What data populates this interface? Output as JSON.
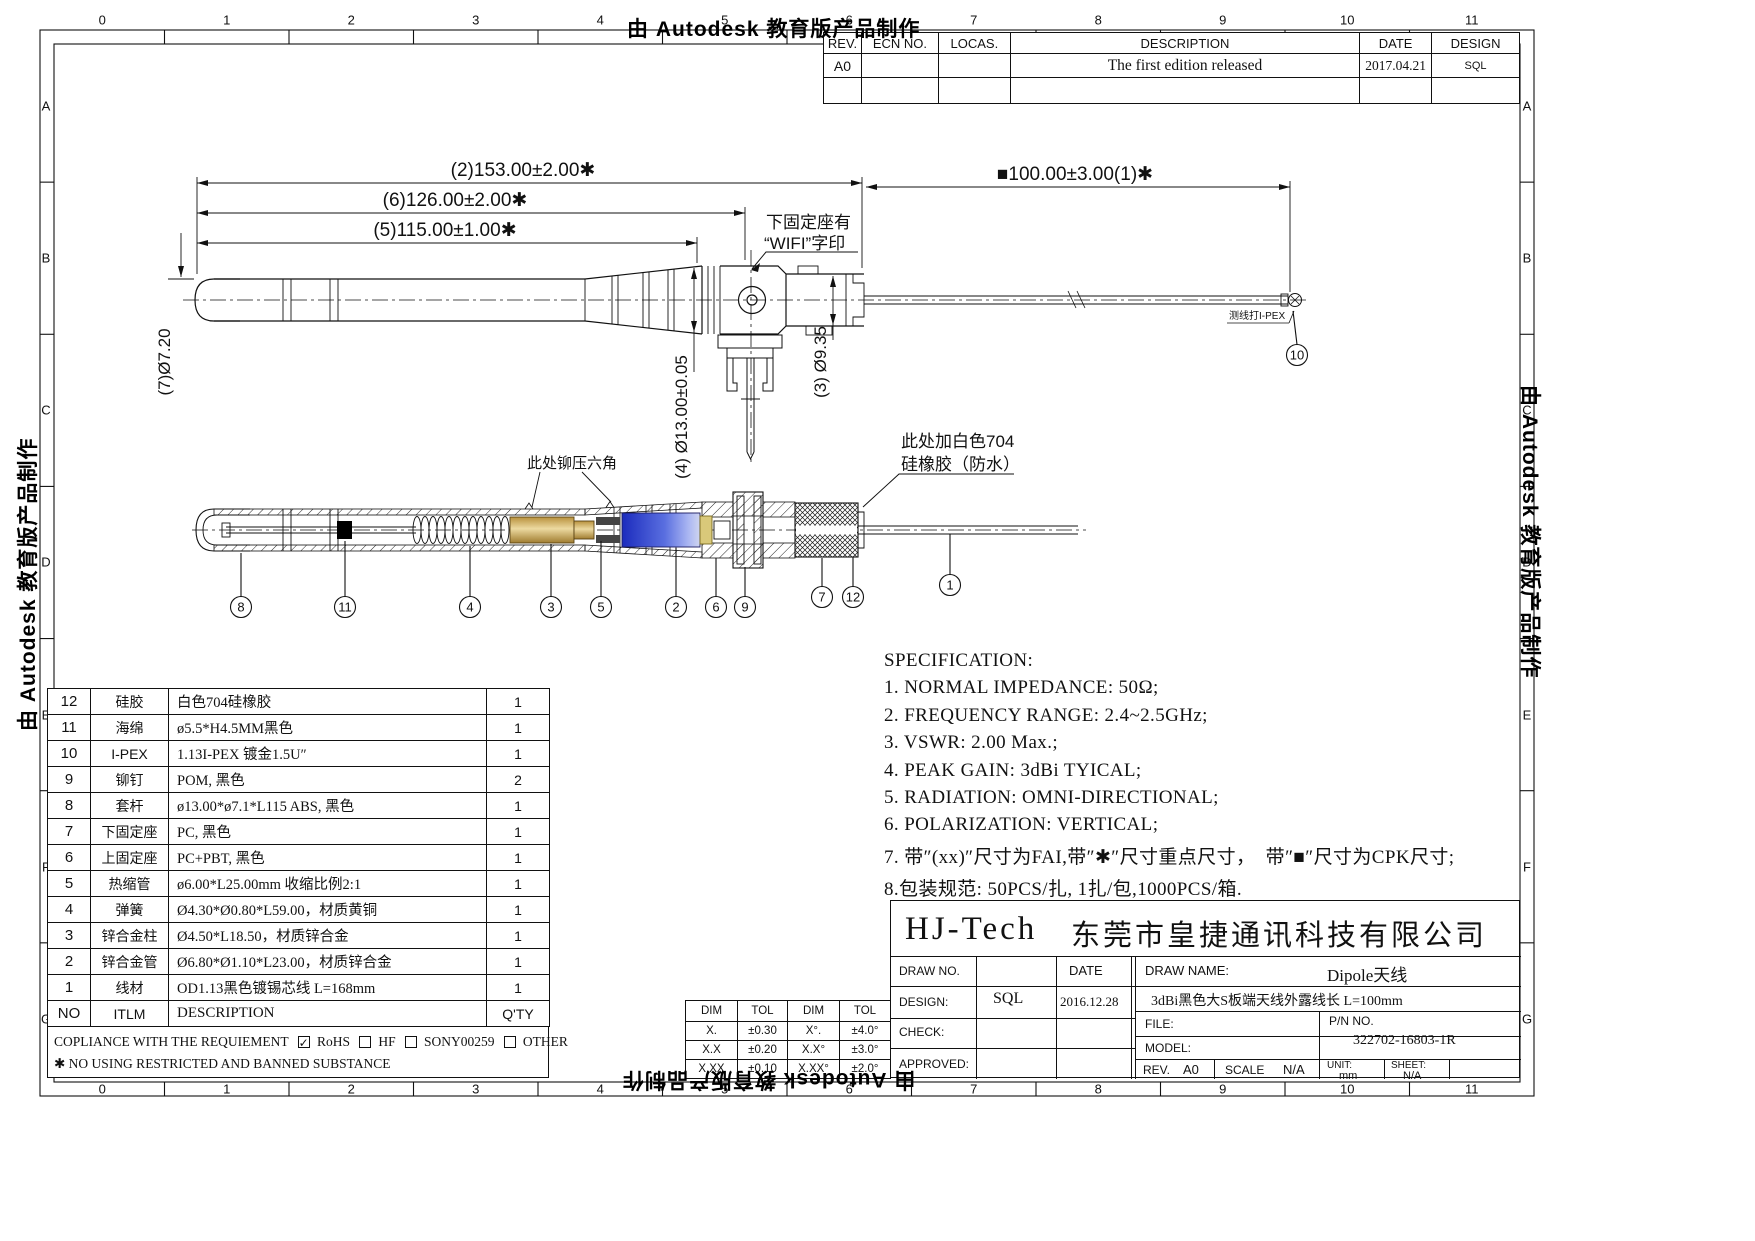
{
  "watermark": {
    "text": "由 Autodesk 教育版产品制作"
  },
  "frame": {
    "column_labels": [
      "0",
      "1",
      "2",
      "3",
      "4",
      "5",
      "6",
      "7",
      "8",
      "9",
      "10",
      "11"
    ],
    "row_labels": [
      "A",
      "B",
      "C",
      "D",
      "E",
      "F",
      "G"
    ]
  },
  "revision_table": {
    "headers": [
      "REV.",
      "ECN NO.",
      "LOCAS.",
      "DESCRIPTION",
      "DATE",
      "DESIGN"
    ],
    "rows": [
      {
        "rev": "A0",
        "ecn_no": "",
        "locas": "",
        "description": "The first edition released",
        "date": "2017.04.21",
        "design": "SQL"
      }
    ]
  },
  "drawing": {
    "dim_153": "(2)153.00±2.00✱",
    "dim_126": "(6)126.00±2.00✱",
    "dim_115": "(5)115.00±1.00✱",
    "dim_100": "■100.00±3.00(1)✱",
    "dim_7_20": "(7)Ø7.20",
    "dim_13": "(4) Ø13.00±0.05",
    "dim_9_35": "(3) Ø9.35",
    "note_wifi_line1": "下固定座有",
    "note_wifi_line2": "“WIFI”字印",
    "note_silicone_line1": "此处加白色704",
    "note_silicone_line2": "硅橡胶（防水）",
    "note_hex": "此处铆压六角",
    "note_ipex": "测线打I-PEX",
    "upper_balloon": {
      "n": "10",
      "x": 1297,
      "y": 355,
      "tx": 1293,
      "ty": 311
    },
    "section_balloons": [
      {
        "n": "8",
        "x": 241,
        "y": 607,
        "tx": 241,
        "ty": 553
      },
      {
        "n": "11",
        "x": 345,
        "y": 607,
        "tx": 345,
        "ty": 541
      },
      {
        "n": "4",
        "x": 470,
        "y": 607,
        "tx": 470,
        "ty": 546
      },
      {
        "n": "3",
        "x": 551,
        "y": 607,
        "tx": 551,
        "ty": 544
      },
      {
        "n": "5",
        "x": 601,
        "y": 607,
        "tx": 601,
        "ty": 541
      },
      {
        "n": "2",
        "x": 676,
        "y": 607,
        "tx": 676,
        "ty": 548
      },
      {
        "n": "6",
        "x": 716,
        "y": 607,
        "tx": 716,
        "ty": 558
      },
      {
        "n": "9",
        "x": 745,
        "y": 607,
        "tx": 745,
        "ty": 567
      },
      {
        "n": "7",
        "x": 822,
        "y": 597,
        "tx": 822,
        "ty": 558
      },
      {
        "n": "12",
        "x": 853,
        "y": 597,
        "tx": 853,
        "ty": 557
      },
      {
        "n": "1",
        "x": 950,
        "y": 585,
        "tx": 950,
        "ty": 534
      }
    ]
  },
  "specification": {
    "title": "SPECIFICATION:",
    "lines": [
      "1. NORMAL IMPEDANCE: 50Ω;",
      "2. FREQUENCY RANGE: 2.4~2.5GHz;",
      "3. VSWR: 2.00 Max.;",
      "4. PEAK GAIN: 3dBi TYICAL;",
      "5. RADIATION: OMNI-DIRECTIONAL;",
      "6. POLARIZATION: VERTICAL;",
      "7. 带″(xx)″尺寸为FAI,带″✱″尺寸重点尺寸，  带″■″尺寸为CPK尺寸;",
      "8.包装规范: 50PCS/扎, 1扎/包,1000PCS/箱."
    ]
  },
  "bom": {
    "headers": {
      "no": "NO",
      "item": "ITLM",
      "description": "DESCRIPTION",
      "qty": "Q'TY"
    },
    "rows": [
      {
        "no": "12",
        "item": "硅胶",
        "description": "白色704硅橡胶",
        "qty": "1"
      },
      {
        "no": "11",
        "item": "海绵",
        "description": "ø5.5*H4.5MM黑色",
        "qty": "1"
      },
      {
        "no": "10",
        "item": "I-PEX",
        "description": "1.13I-PEX 镀金1.5U″",
        "qty": "1"
      },
      {
        "no": "9",
        "item": "铆钉",
        "description": "POM, 黑色",
        "qty": "2"
      },
      {
        "no": "8",
        "item": "套杆",
        "description": "ø13.00*ø7.1*L115 ABS, 黑色",
        "qty": "1"
      },
      {
        "no": "7",
        "item": "下固定座",
        "description": "PC, 黑色",
        "qty": "1"
      },
      {
        "no": "6",
        "item": "上固定座",
        "description": "PC+PBT, 黑色",
        "qty": "1"
      },
      {
        "no": "5",
        "item": "热缩管",
        "description": "ø6.00*L25.00mm  收缩比例2:1",
        "qty": "1"
      },
      {
        "no": "4",
        "item": "弹簧",
        "description": "Ø4.30*Ø0.80*L59.00，材质黄铜",
        "qty": "1"
      },
      {
        "no": "3",
        "item": "锌合金柱",
        "description": "Ø4.50*L18.50，材质锌合金",
        "qty": "1"
      },
      {
        "no": "2",
        "item": "锌合金管",
        "description": "Ø6.80*Ø1.10*L23.00，材质锌合金",
        "qty": "1"
      },
      {
        "no": "1",
        "item": "线材",
        "description": "OD1.13黑色镀锡芯线 L=168mm",
        "qty": "1"
      }
    ],
    "compliance": {
      "prefix": "COPLIANCE WITH THE REQUIEMENT",
      "options": [
        {
          "label": "RoHS",
          "checked": true
        },
        {
          "label": "HF",
          "checked": false
        },
        {
          "label": "SONY00259",
          "checked": false
        },
        {
          "label": "OTHER",
          "checked": false
        }
      ],
      "note": "✱ NO USING RESTRICTED AND BANNED SUBSTANCE"
    }
  },
  "tolerance_table": {
    "headers": [
      "DIM",
      "TOL",
      "DIM",
      "TOL"
    ],
    "rows": [
      [
        "X.",
        "±0.30",
        "X°.",
        "±4.0°"
      ],
      [
        "X.X",
        "±0.20",
        "X.X°",
        "±3.0°"
      ],
      [
        "X.XX",
        "±0.10",
        "X.XX°",
        "±2.0°"
      ]
    ]
  },
  "title_block": {
    "logo": "HJ-Tech",
    "company": "东莞市皇捷通讯科技有限公司",
    "draw_no_label": "DRAW NO.",
    "date_label": "DATE",
    "design_label": "DESIGN:",
    "design_value": "SQL",
    "design_date": "2016.12.28",
    "check_label": "CHECK:",
    "approved_label": "APPROVED:",
    "draw_name_label": "DRAW NAME:",
    "draw_name_value": "Dipole天线",
    "draw_name_sub": "3dBi黑色大S板端天线外露线长 L=100mm",
    "file_label": "FILE:",
    "pn_label": "P/N NO.",
    "pn_value": "322702-16803-1R",
    "model_label": "MODEL:",
    "rev_label": "REV.",
    "rev_value": "A0",
    "scale_label": "SCALE",
    "scale_value": "N/A",
    "unit_label": "UNIT:",
    "unit_value": "mm",
    "sheet_label": "SHEET:",
    "sheet_value": "N/A"
  },
  "colors": {
    "line": "#111111",
    "gold_part": "#c79a4b",
    "blue_part": "#2233cc",
    "brass_strip": "#d9c97a",
    "sponge_black": "#000000"
  }
}
